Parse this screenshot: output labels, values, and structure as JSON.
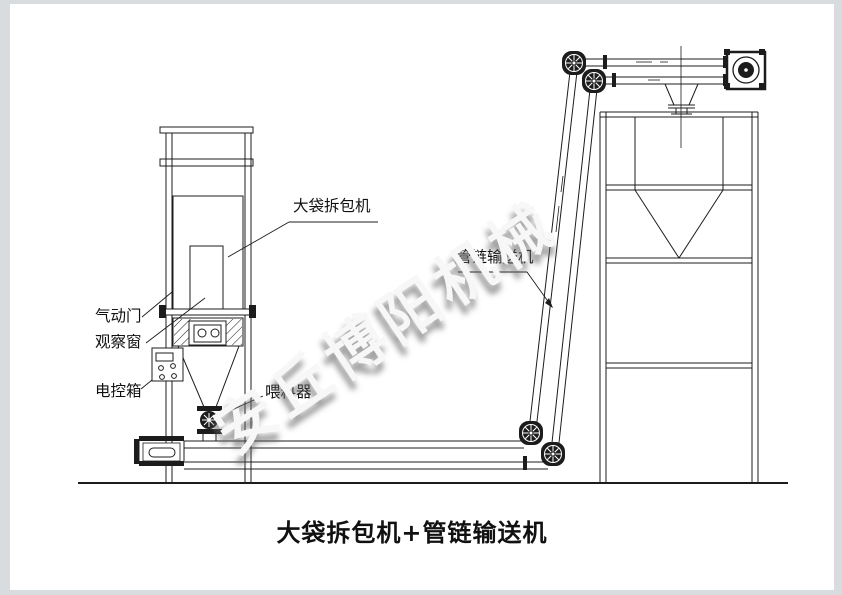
{
  "window": {
    "width": 842,
    "height": 595
  },
  "colors": {
    "sheet": "#ffffff",
    "outer_frame": "#d9dcde",
    "line": "#1c1c1c",
    "label_text": "#111111",
    "watermark_text": "#f7f7f7"
  },
  "diagram": {
    "caption": "大袋拆包机+管链输送机",
    "watermark": "安丘博阳机械",
    "labels": {
      "bag_breaker": "大袋拆包机",
      "pneumatic_door": "气动门",
      "observation_window": "观察窗",
      "control_box": "电控箱",
      "feeder": "喂料器",
      "pipe_chain_conveyor": "管链输送机"
    }
  }
}
